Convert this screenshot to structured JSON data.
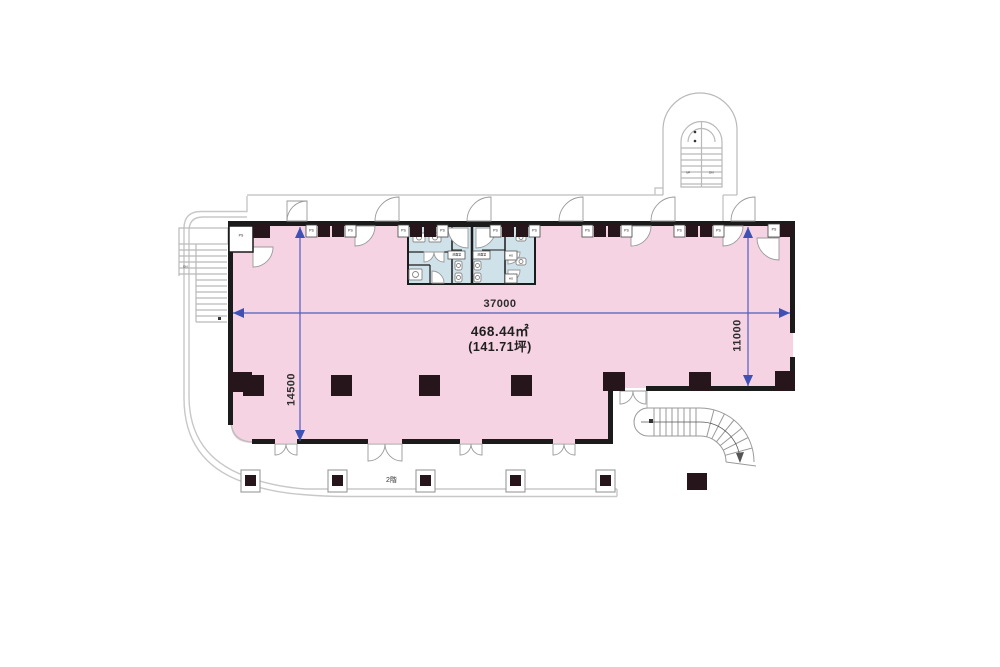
{
  "document": {
    "type": "building-floor-plan"
  },
  "plan": {
    "area": {
      "m2": "468.44㎡",
      "tsubo": "(141.71坪)"
    },
    "dimensions": {
      "width": "37000",
      "depth_left": "14500",
      "depth_right": "11000"
    },
    "floor_label": "2階",
    "labels": {
      "ps": "PS",
      "up": "UP",
      "dn": "DN",
      "washroom": "洗面室",
      "hg": "HG"
    },
    "colors": {
      "floor_pink": "#f5d3e2",
      "wet_area_blue": "#cfe2ea",
      "wall_black": "#1b1b1b",
      "column_dark": "#26151b",
      "dimension_blue": "#4f5fbe",
      "outline_gray": "#c8c8c8"
    }
  }
}
